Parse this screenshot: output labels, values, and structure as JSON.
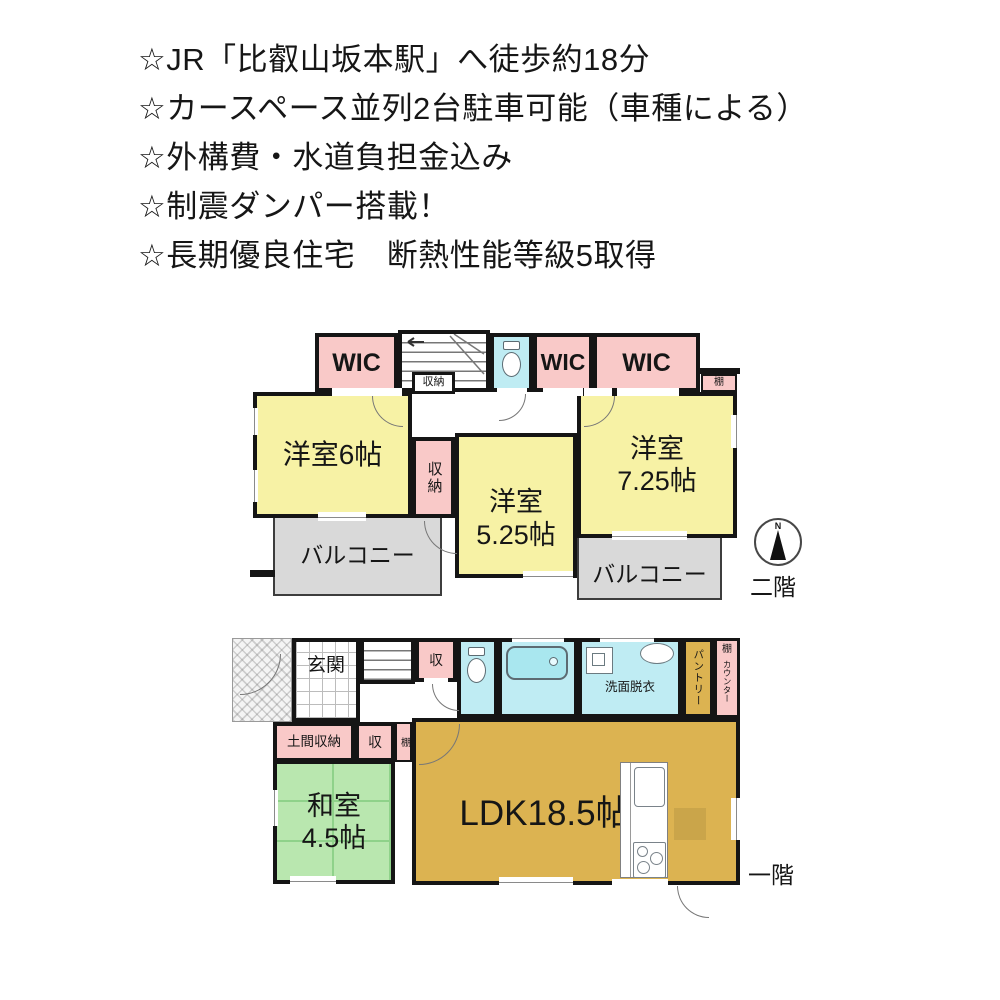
{
  "highlights": {
    "lines": [
      "☆JR「比叡山坂本駅」へ徒歩約18分",
      "☆カースペース並列2台駐車可能（車種による）",
      "☆外構費・水道負担金込み",
      "☆制震ダンパー搭載！",
      "☆長期優良住宅　断熱性能等級5取得"
    ]
  },
  "floor2": {
    "floor_label": "二階",
    "compass_north": "N",
    "wic1": "WIC",
    "wic2": "WIC",
    "wic3": "WIC",
    "stair_closet": "収納",
    "shelf": "棚",
    "room6": "洋室6帖",
    "closet": "収納",
    "room525_name": "洋室",
    "room525_size": "5.25帖",
    "room725_name": "洋室",
    "room725_size": "7.25帖",
    "balcony1": "バルコニー",
    "balcony2": "バルコニー"
  },
  "floor1": {
    "floor_label": "一階",
    "genkan": "玄関",
    "closet_top": "収",
    "washroom": "洗面脱衣",
    "pantry": "パントリー",
    "shelf_top": "棚",
    "counter": "カウンター",
    "doma_storage": "土間収納",
    "closet_mid": "収",
    "shelf_mid": "棚",
    "washitsu_name": "和室",
    "washitsu_size": "4.5帖",
    "ldk": "LDK18.5帖"
  },
  "colors": {
    "room_pink": "#f9c9c8",
    "room_yellow": "#f7f2a5",
    "room_cyan": "#bfecf3",
    "room_green": "#b9e7af",
    "room_tan": "#dcb351",
    "balcony_gray": "#d9d9d9",
    "wall": "#151515"
  }
}
